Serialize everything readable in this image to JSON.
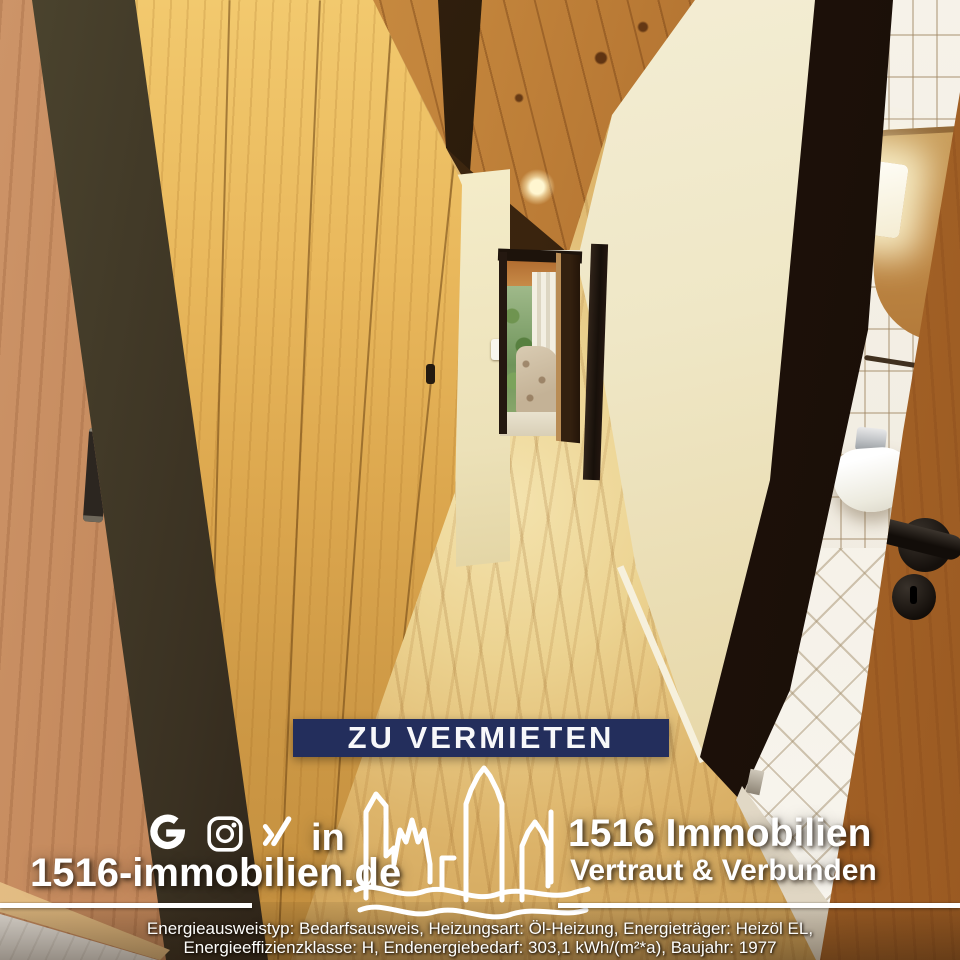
{
  "overlay": {
    "banner": {
      "label": "ZU VERMIETEN",
      "bg_color": "#232e5c",
      "text_color": "#f7f8fa"
    },
    "social": {
      "google_glyph": "G",
      "linkedin_glyph": "in",
      "icons": [
        "google",
        "instagram",
        "xing",
        "linkedin"
      ]
    },
    "website": "1516-immobilien.de",
    "company": {
      "name": "1516 Immobilien",
      "tagline": "Vertraut & Verbunden"
    },
    "logo": {
      "name": "skyline-with-river-waves",
      "color": "#ffffff"
    },
    "footer": {
      "line1": "Energieausweistyp: Bedarfsausweis, Heizungsart: Öl-Heizung, Energieträger: Heizöl EL,",
      "line2": "Energieeffizienzklasse: H, Endenergiebedarf: 303,1 kWh/(m²*a), Baujahr: 1977"
    }
  },
  "scene": {
    "subject": "hallway with wood paneling, wooden ceiling and bathroom",
    "palette": {
      "ceiling_wood": "#b06a2e",
      "closet_wood": "#dca74e",
      "left_door_wood": "#bd8154",
      "dark_frames": "#241a12",
      "cream_wall": "#efe7c6",
      "bath_tiles": "#f1ece1",
      "oak_door": "#b97c3d",
      "floor_oak": "#ddb46a"
    }
  }
}
